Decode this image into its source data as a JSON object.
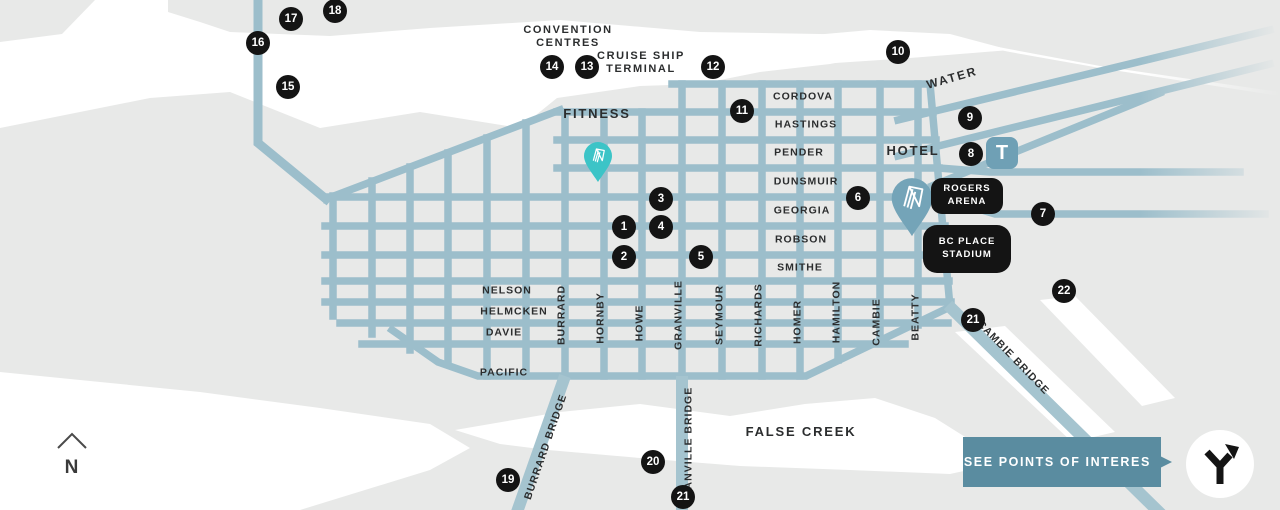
{
  "colors": {
    "land": "#E8E9E8",
    "water": "#FFFFFF",
    "street": "#9CBECB",
    "bridge": "#A5C4CF",
    "marker_bg": "#141414",
    "fitness_pin": "#3CC4C7",
    "hotel_pin": "#74A4B8",
    "transit_icon_bg": "#6FA0B5",
    "cta_bg": "#5A8CA0",
    "label_text": "#2B2D2E"
  },
  "compass": {
    "label": "N"
  },
  "transit": {
    "label": "T"
  },
  "cta": {
    "label": "SEE POINTS OF INTEREST"
  },
  "badges": [
    {
      "text": "ROGERS\nARENA"
    },
    {
      "text": "BC PLACE\nSTADIUM"
    }
  ],
  "labels": [
    {
      "name": "area-label-convention-centres",
      "text": "CONVENTION\nCENTRES",
      "x": 568,
      "y": 37,
      "cls": "lbl-area"
    },
    {
      "name": "area-label-cruise-ship-terminal",
      "text": "CRUISE SHIP\nTERMINAL",
      "x": 641,
      "y": 63,
      "cls": "lbl-area"
    },
    {
      "name": "area-label-fitness",
      "text": "FITNESS",
      "x": 597,
      "y": 114,
      "cls": "lbl-area-lg"
    },
    {
      "name": "area-label-hotel",
      "text": "HOTEL",
      "x": 913,
      "y": 151,
      "cls": "lbl-area-lg"
    },
    {
      "name": "area-label-false-creek",
      "text": "FALSE CREEK",
      "x": 801,
      "y": 432,
      "cls": "lbl-area-lg"
    },
    {
      "name": "street-label-water",
      "text": "WATER",
      "x": 952,
      "y": 78,
      "rot": -16,
      "cls": "lbl-street-lg"
    },
    {
      "name": "street-label-cordova",
      "text": "CORDOVA",
      "x": 803,
      "y": 97,
      "cls": "lbl-street"
    },
    {
      "name": "street-label-hastings",
      "text": "HASTINGS",
      "x": 806,
      "y": 125,
      "cls": "lbl-street"
    },
    {
      "name": "street-label-pender",
      "text": "PENDER",
      "x": 799,
      "y": 153,
      "cls": "lbl-street"
    },
    {
      "name": "street-label-dunsmuir",
      "text": "DUNSMUIR",
      "x": 806,
      "y": 182,
      "cls": "lbl-street"
    },
    {
      "name": "street-label-georgia",
      "text": "GEORGIA",
      "x": 802,
      "y": 211,
      "cls": "lbl-street"
    },
    {
      "name": "street-label-robson",
      "text": "ROBSON",
      "x": 801,
      "y": 240,
      "cls": "lbl-street"
    },
    {
      "name": "street-label-smithe",
      "text": "SMITHE",
      "x": 800,
      "y": 268,
      "cls": "lbl-street"
    },
    {
      "name": "street-label-nelson",
      "text": "NELSON",
      "x": 507,
      "y": 291,
      "cls": "lbl-street"
    },
    {
      "name": "street-label-helmcken",
      "text": "HELMCKEN",
      "x": 514,
      "y": 312,
      "cls": "lbl-street"
    },
    {
      "name": "street-label-davie",
      "text": "DAVIE",
      "x": 504,
      "y": 333,
      "cls": "lbl-street"
    },
    {
      "name": "street-label-pacific",
      "text": "PACIFIC",
      "x": 504,
      "y": 373,
      "cls": "lbl-street"
    },
    {
      "name": "street-label-burrard",
      "text": "BURRARD",
      "x": 562,
      "y": 315,
      "rot": -90,
      "cls": "lbl-street"
    },
    {
      "name": "street-label-hornby",
      "text": "HORNBY",
      "x": 601,
      "y": 318,
      "rot": -90,
      "cls": "lbl-street"
    },
    {
      "name": "street-label-howe",
      "text": "HOWE",
      "x": 640,
      "y": 323,
      "rot": -90,
      "cls": "lbl-street"
    },
    {
      "name": "street-label-granville",
      "text": "GRANVILLE",
      "x": 679,
      "y": 315,
      "rot": -90,
      "cls": "lbl-street"
    },
    {
      "name": "street-label-seymour",
      "text": "SEYMOUR",
      "x": 720,
      "y": 315,
      "rot": -90,
      "cls": "lbl-street"
    },
    {
      "name": "street-label-richards",
      "text": "RICHARDS",
      "x": 759,
      "y": 315,
      "rot": -90,
      "cls": "lbl-street"
    },
    {
      "name": "street-label-homer",
      "text": "HOMER",
      "x": 798,
      "y": 322,
      "rot": -90,
      "cls": "lbl-street"
    },
    {
      "name": "street-label-hamilton",
      "text": "HAMILTON",
      "x": 837,
      "y": 312,
      "rot": -90,
      "cls": "lbl-street"
    },
    {
      "name": "street-label-cambie",
      "text": "CAMBIE",
      "x": 877,
      "y": 322,
      "rot": -90,
      "cls": "lbl-street"
    },
    {
      "name": "street-label-beatty",
      "text": "BEATTY",
      "x": 916,
      "y": 317,
      "rot": -90,
      "cls": "lbl-street"
    },
    {
      "name": "bridge-label-burrard-bridge",
      "text": "BURRARD BRIDGE",
      "x": 546,
      "y": 447,
      "rot": -71,
      "cls": "lbl-street"
    },
    {
      "name": "bridge-label-granville-bridge",
      "text": "GRANVILLE BRIDGE",
      "x": 689,
      "y": 447,
      "rot": -90,
      "cls": "lbl-street"
    },
    {
      "name": "bridge-label-cambie-bridge",
      "text": "CAMBIE BRIDGE",
      "x": 1013,
      "y": 358,
      "rot": 46,
      "cls": "lbl-street"
    }
  ],
  "markers": [
    {
      "name": "marker-1",
      "n": "1",
      "x": 624,
      "y": 227
    },
    {
      "name": "marker-2",
      "n": "2",
      "x": 624,
      "y": 257
    },
    {
      "name": "marker-3",
      "n": "3",
      "x": 661,
      "y": 199
    },
    {
      "name": "marker-4",
      "n": "4",
      "x": 661,
      "y": 227
    },
    {
      "name": "marker-5",
      "n": "5",
      "x": 701,
      "y": 257
    },
    {
      "name": "marker-6",
      "n": "6",
      "x": 858,
      "y": 198
    },
    {
      "name": "marker-7",
      "n": "7",
      "x": 1043,
      "y": 214
    },
    {
      "name": "marker-8",
      "n": "8",
      "x": 971,
      "y": 154
    },
    {
      "name": "marker-9",
      "n": "9",
      "x": 970,
      "y": 118
    },
    {
      "name": "marker-10",
      "n": "10",
      "x": 898,
      "y": 52
    },
    {
      "name": "marker-11",
      "n": "11",
      "x": 742,
      "y": 111
    },
    {
      "name": "marker-12",
      "n": "12",
      "x": 713,
      "y": 67
    },
    {
      "name": "marker-13",
      "n": "13",
      "x": 587,
      "y": 67
    },
    {
      "name": "marker-14",
      "n": "14",
      "x": 552,
      "y": 67
    },
    {
      "name": "marker-15",
      "n": "15",
      "x": 288,
      "y": 87
    },
    {
      "name": "marker-16",
      "n": "16",
      "x": 258,
      "y": 43
    },
    {
      "name": "marker-17",
      "n": "17",
      "x": 291,
      "y": 19
    },
    {
      "name": "marker-18",
      "n": "18",
      "x": 335,
      "y": 11
    },
    {
      "name": "marker-19",
      "n": "19",
      "x": 508,
      "y": 480
    },
    {
      "name": "marker-20",
      "n": "20",
      "x": 653,
      "y": 462
    },
    {
      "name": "marker-21-cambie",
      "n": "21",
      "x": 973,
      "y": 320
    },
    {
      "name": "marker-21-granville",
      "n": "21",
      "x": 683,
      "y": 497
    },
    {
      "name": "marker-22",
      "n": "22",
      "x": 1064,
      "y": 291
    }
  ]
}
